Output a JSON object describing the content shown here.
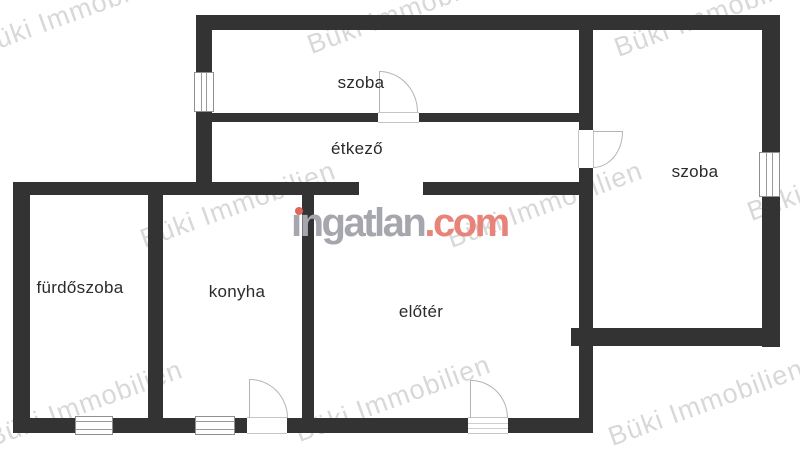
{
  "watermark": {
    "text": "Büki Immobilien",
    "color": "#b9b9b9",
    "rotation_deg": -20,
    "font_size": 27,
    "positions": [
      {
        "x": 75,
        "y": 12
      },
      {
        "x": 405,
        "y": 11
      },
      {
        "x": 712,
        "y": 14
      },
      {
        "x": 238,
        "y": 205
      },
      {
        "x": 545,
        "y": 205
      },
      {
        "x": 845,
        "y": 178
      },
      {
        "x": 85,
        "y": 404
      },
      {
        "x": 393,
        "y": 399
      },
      {
        "x": 706,
        "y": 403
      }
    ]
  },
  "logo": {
    "name": "ingatlan",
    "display_name": "ıngatlan",
    "suffix": ".com",
    "gray_color": "#a6a6ae",
    "red_color": "#e8837a",
    "dot_color": "#e0655a"
  },
  "rooms": [
    {
      "id": "szoba-top",
      "label": "szoba",
      "cx": 361,
      "cy": 83
    },
    {
      "id": "etkezo",
      "label": "étkező",
      "cx": 357,
      "cy": 149
    },
    {
      "id": "szoba-right",
      "label": "szoba",
      "cx": 695,
      "cy": 172
    },
    {
      "id": "furdoszoba",
      "label": "fürdőszoba",
      "cx": 80,
      "cy": 288
    },
    {
      "id": "konyha",
      "label": "konyha",
      "cx": 237,
      "cy": 292
    },
    {
      "id": "eloter",
      "label": "előtér",
      "cx": 421,
      "cy": 312
    }
  ],
  "plan": {
    "wall_color": "#333333",
    "walls": [
      {
        "name": "top-wall",
        "x": 196,
        "y": 15,
        "w": 584,
        "h": 15
      },
      {
        "name": "left-upper-wall",
        "x": 196,
        "y": 15,
        "w": 16,
        "h": 180
      },
      {
        "name": "mid-vertical-wall",
        "x": 579,
        "y": 15,
        "w": 14,
        "h": 418
      },
      {
        "name": "right-wall",
        "x": 762,
        "y": 15,
        "w": 18,
        "h": 332
      },
      {
        "name": "szoba-divider-wall",
        "x": 212,
        "y": 113,
        "w": 367,
        "h": 9
      },
      {
        "name": "west-horizontal-wall",
        "x": 13,
        "y": 182,
        "w": 346,
        "h": 13
      },
      {
        "name": "east-horizontal-wall",
        "x": 423,
        "y": 182,
        "w": 156,
        "h": 13
      },
      {
        "name": "left-lower-wall",
        "x": 13,
        "y": 182,
        "w": 17,
        "h": 251
      },
      {
        "name": "bottom-wall",
        "x": 13,
        "y": 418,
        "w": 580,
        "h": 15
      },
      {
        "name": "bath-kitchen-wall",
        "x": 148,
        "y": 195,
        "w": 15,
        "h": 238
      },
      {
        "name": "kitchen-hall-wall",
        "x": 302,
        "y": 188,
        "w": 12,
        "h": 230
      },
      {
        "name": "szoba2-bottom-wall",
        "x": 571,
        "y": 328,
        "w": 209,
        "h": 18
      }
    ],
    "windows": [
      {
        "name": "window-left-wall",
        "x": 194,
        "y": 72,
        "w": 20,
        "h": 40,
        "orientation": "v"
      },
      {
        "name": "window-right-wall",
        "x": 759,
        "y": 152,
        "w": 21,
        "h": 45,
        "orientation": "v"
      },
      {
        "name": "window-bath-bottom",
        "x": 75,
        "y": 416,
        "w": 38,
        "h": 19,
        "orientation": "h"
      },
      {
        "name": "window-kitchen-bottom",
        "x": 195,
        "y": 416,
        "w": 40,
        "h": 19,
        "orientation": "h"
      }
    ],
    "door_gaps": [
      {
        "name": "gap-szoba-top-door",
        "x": 378,
        "y": 112,
        "w": 41,
        "h": 11,
        "orientation": "h",
        "style": "plain"
      },
      {
        "name": "gap-szoba-right-door",
        "x": 578,
        "y": 130,
        "w": 16,
        "h": 38,
        "orientation": "v",
        "style": "plain"
      },
      {
        "name": "gap-kitchen-door",
        "x": 247,
        "y": 417,
        "w": 40,
        "h": 17,
        "orientation": "h",
        "style": "plain"
      },
      {
        "name": "gap-entry-door",
        "x": 468,
        "y": 417,
        "w": 40,
        "h": 17,
        "orientation": "h",
        "style": "threshold"
      }
    ],
    "door_arcs": [
      {
        "name": "arc-szoba-top-door",
        "x": 379,
        "y": 71,
        "w": 39,
        "h": 41,
        "corner": "tr"
      },
      {
        "name": "arc-szoba-right-door",
        "x": 593,
        "y": 132,
        "w": 30,
        "h": 36,
        "corner": "br"
      },
      {
        "name": "arc-kitchen-door",
        "x": 250,
        "y": 379,
        "w": 38,
        "h": 39,
        "corner": "tr"
      },
      {
        "name": "arc-entry-door",
        "x": 471,
        "y": 380,
        "w": 37,
        "h": 38,
        "corner": "tr"
      }
    ],
    "door_leaves": [
      {
        "name": "leaf-szoba-top-door",
        "x": 379,
        "y": 71,
        "w": 1,
        "h": 41
      },
      {
        "name": "leaf-szoba-right-door",
        "x": 593,
        "y": 131,
        "w": 30,
        "h": 1
      },
      {
        "name": "leaf-kitchen-door",
        "x": 249,
        "y": 379,
        "w": 1,
        "h": 39
      },
      {
        "name": "leaf-entry-door",
        "x": 470,
        "y": 380,
        "w": 1,
        "h": 38
      }
    ]
  }
}
